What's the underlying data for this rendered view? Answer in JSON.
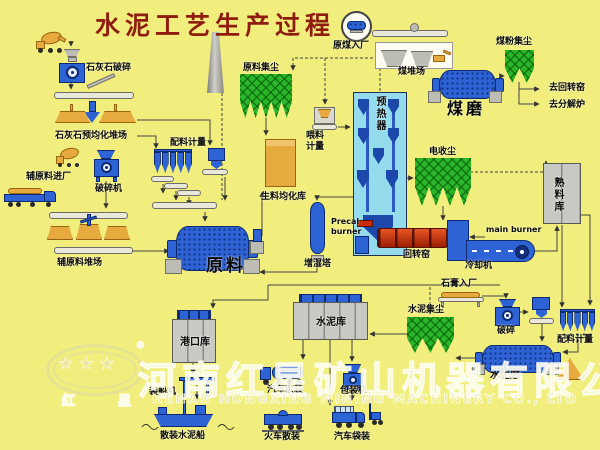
{
  "title": "水泥工艺生产过程",
  "labels": {
    "limestone_crushing": "石灰石破碎",
    "limestone_preblending_yard": "石灰石预均化堆场",
    "aux_material_entry": "辅原料进厂",
    "crusher": "破碎机",
    "aux_material_yard": "辅原料堆场",
    "batching_metering_left": "配料计量",
    "raw_material_dust_collector": "原料集尘",
    "raw_mill": "原料",
    "raw_meal_homogenizing_silo": "生料均化库",
    "feeding_metering": "喂料\n计量",
    "preheater": "预热器",
    "precal_burner": "Precal\nburner",
    "humidifying_tower": "增湿塔",
    "electrostatic_precipitator": "电收尘",
    "rotary_kiln": "回转窑",
    "main_burner": "main burner",
    "cooler": "冷却机",
    "clinker_silo": "熟料库",
    "raw_coal_entry": "原煤入厂",
    "coal_yard": "煤堆场",
    "coal_mill": "煤磨",
    "coal_dust_collector": "煤粉集尘",
    "to_rotary_kiln": "去回转窑",
    "to_calciner": "去分解炉",
    "gypsum_entry": "石膏入厂",
    "cement_dust_collector": "水泥集尘",
    "gypsum_crushing": "破碎",
    "batching_metering_right": "配料计量",
    "cement_mill": "水泥磨",
    "cement_silo": "水泥库",
    "port_silo": "港口库",
    "ship_loader": "装船机",
    "bulk_cement_ship": "散装水泥船",
    "truck_bulk_loading": "汽车散装",
    "packing_machine": "包装机",
    "train_bulk_loading": "火车散装",
    "truck_bag_loading": "汽车袋装"
  },
  "watermark": {
    "company_cn": "河南红星矿山机器有限公司",
    "company_en": "HENAN HONGXING MINING MACHINERY CO., LTD",
    "logo_brand_left": "红",
    "logo_brand_right": "星",
    "logo_stars": "★ ★ ★",
    "registered_mark": "®"
  },
  "colors": {
    "background": "#f1ee7d",
    "title_red": "#8e1c10",
    "equipment_blue": "#2e63d6",
    "dust_collector_green": "#2ab52a",
    "kiln_red": "#cc2b05",
    "material_orange": "#e7aa3f",
    "silo_gray": "#c9c9c3",
    "preheater_cyan": "#93dbed"
  }
}
